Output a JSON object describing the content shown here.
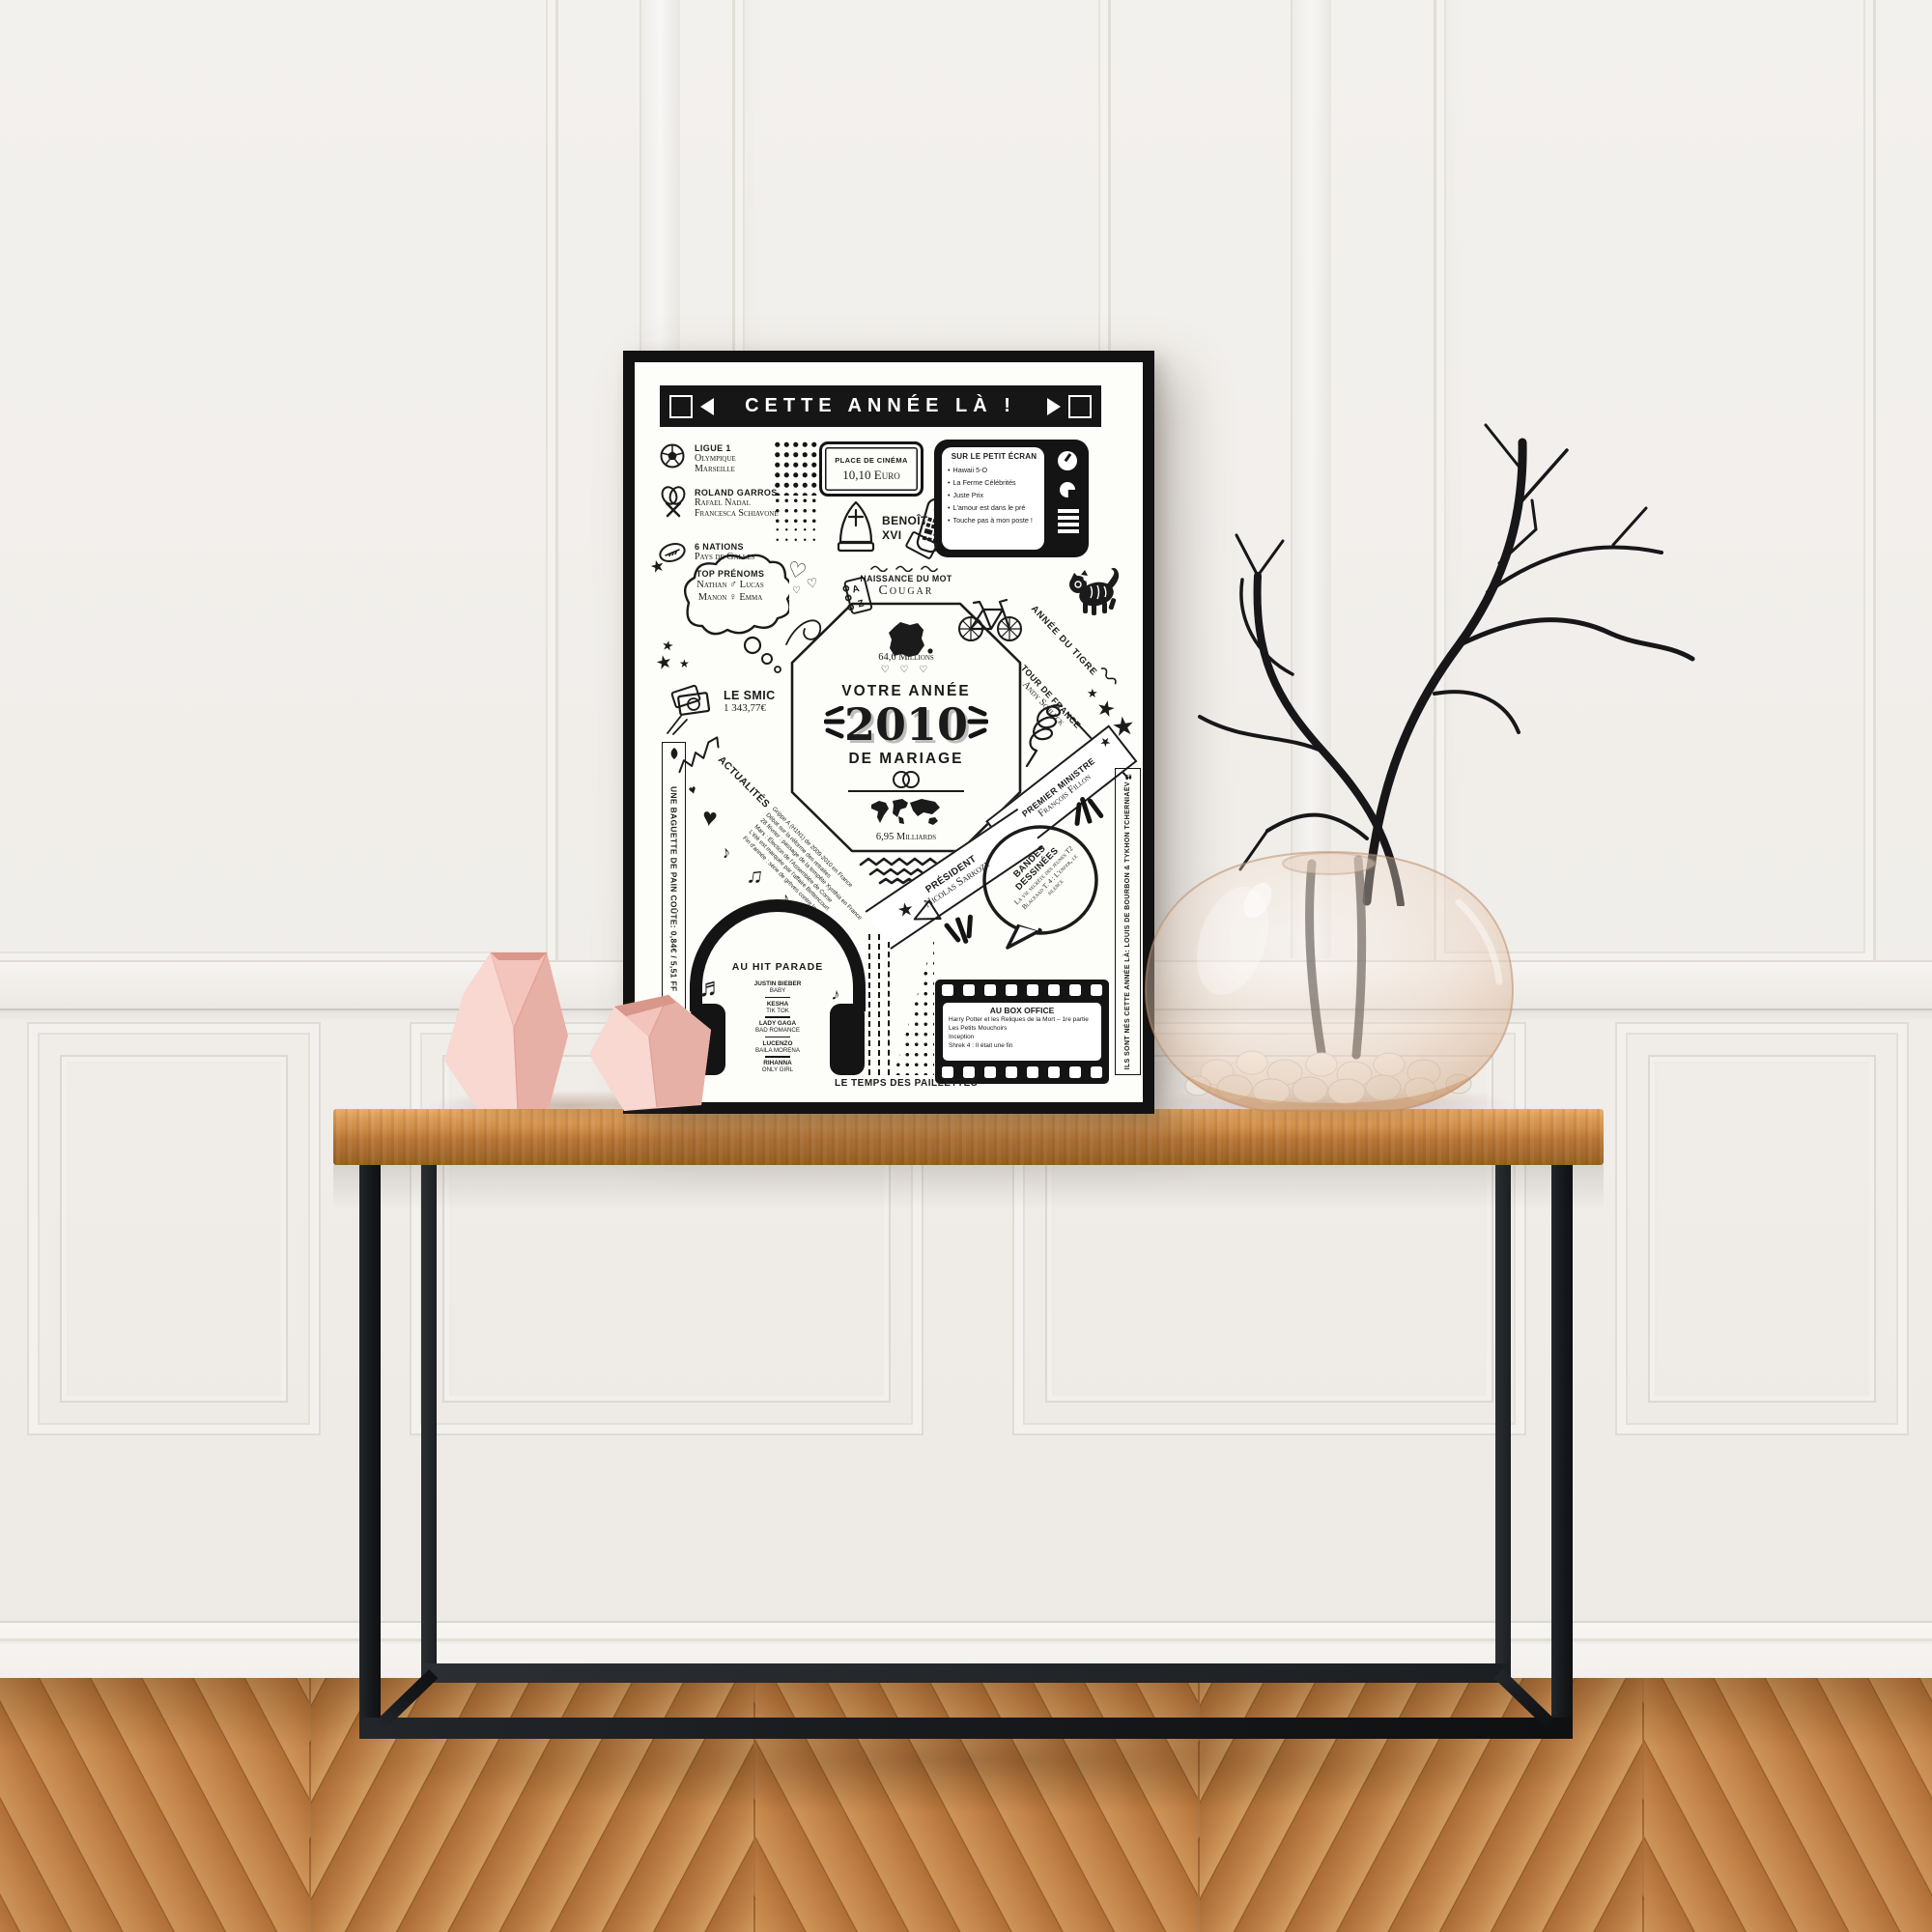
{
  "poster": {
    "banner": {
      "title": "CETTE ANNÉE LÀ !"
    },
    "sports": {
      "items": [
        {
          "label": "LIGUE 1",
          "lines": [
            "Olympique",
            "Marseille"
          ]
        },
        {
          "label": "ROLAND GARROS",
          "lines": [
            "Rafael Nadal",
            "Francesca Schiavone"
          ]
        },
        {
          "label": "6 NATIONS",
          "lines": [
            "Pays de Galles"
          ]
        }
      ]
    },
    "ticket": {
      "label": "PLACE DE CINÉMA",
      "value": "10,10 Euro"
    },
    "pope": {
      "line1": "BENOÎT",
      "line2": "XVI"
    },
    "tv": {
      "title": "SUR LE PETIT ÉCRAN",
      "items": [
        "Hawaii 5-O",
        "La Ferme Célébrités",
        "Juste Prix",
        "L'amour est dans le pré",
        "Touche pas à mon poste !"
      ]
    },
    "prenoms": {
      "title": "TOP PRÉNOMS",
      "line1": "Nathan ♂ Lucas",
      "line2": "Manon ♀ Emma"
    },
    "word": {
      "label": "NAISSANCE DU MOT",
      "value": "Cougar"
    },
    "tiger": {
      "label": "ANNÉE DU TIGRE"
    },
    "tour": {
      "label": "TOUR DE FRANCE",
      "value": "Andy Schleck"
    },
    "smic": {
      "label": "LE SMIC",
      "value": "1 343,77€"
    },
    "center": {
      "top_caption": "64,6 Millions",
      "hearts": "♡ ♡ ♡",
      "line1": "VOTRE ANNÉE",
      "year": "2010",
      "line2": "DE MARIAGE",
      "bottom_caption": "6,95 Milliards"
    },
    "pm": {
      "label": "PREMIER MINISTRE",
      "value": "François Fillon"
    },
    "president": {
      "label": "PRÉSIDENT",
      "value": "Nicolas Sarkozy"
    },
    "bd": {
      "title": "BANDES DESSINÉES",
      "items": [
        "La vie secrète des jeunes T2",
        "Blacksad T. 4 : L'enfer, le silence"
      ]
    },
    "actualites": {
      "title": "ACTUALITÉS",
      "items": [
        "Grippe A (H1N1) de 2009-2010 en France",
        "Débat sur la réforme des retraites",
        "28 février : passage de la tempête Xynthia en France",
        "Mars : Élection de l'Assemblée de Corse",
        "L'été est marquée par l'affaire Bettencourt",
        "Fin d'année : série de grèves contre la réforme des retraites"
      ]
    },
    "baguette": {
      "text": "UNE BAGUETTE DE PAIN COÛTE: 0,84€ / 5,51 FF"
    },
    "hit_parade": {
      "title": "AU HIT PARADE",
      "entries": [
        {
          "artist": "JUSTIN BIEBER",
          "song": "BABY"
        },
        {
          "artist": "KESHA",
          "song": "TIK TOK"
        },
        {
          "artist": "LADY GAGA",
          "song": "BAD ROMANCE"
        },
        {
          "artist": "LUCENZO",
          "song": "BAILA MORENA"
        },
        {
          "artist": "RIHANNA",
          "song": "ONLY GIRL"
        }
      ]
    },
    "box_office": {
      "title": "AU BOX OFFICE",
      "items": [
        "Harry Potter et les Reliques de la Mort – 1re partie",
        "Les Petits Mouchoirs",
        "Inception",
        "Shrek 4 : Il était une fin"
      ]
    },
    "births": {
      "text": "ILS SONT NÉS CETTE ANNÉE LÀ: LOUIS DE BOURBON & TYKHON TCHERNIAËV"
    },
    "footer": {
      "text": "LE TEMPS DES PAILLETTES"
    },
    "doodles": {
      "star": "★",
      "heart": "♥",
      "heart_outline": "♡",
      "note": "♪",
      "double_note": "♫",
      "clef": "♬",
      "az_a": "A",
      "az_b": "Z"
    }
  },
  "colors": {
    "ink": "#1b1b1b",
    "paper": "#fdfdfa",
    "frame": "#121212",
    "wall": "#f1eeea",
    "table_wood": "#cd8d49",
    "floor_wood": "#b97a45",
    "vase_pink": "#f2c4bb",
    "glass_tint": "#e9cdb9",
    "branches": "#17171a"
  }
}
